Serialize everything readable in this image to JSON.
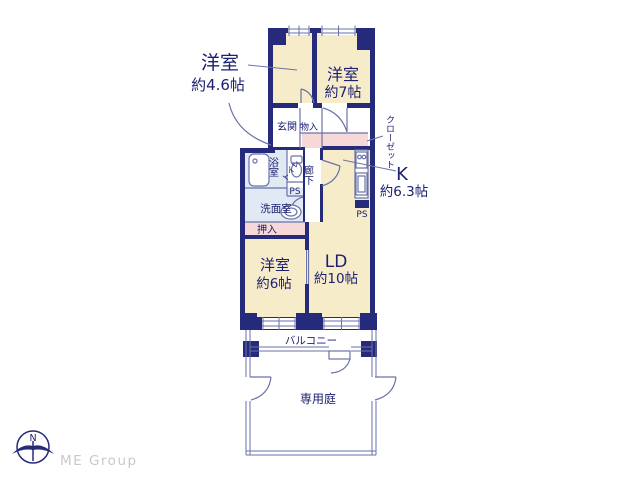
{
  "rooms": {
    "bedroom46": {
      "label": "洋室",
      "size": "約4.6帖"
    },
    "bedroom7": {
      "label": "洋室",
      "size": "約7帖"
    },
    "bedroom6": {
      "label": "洋室",
      "size": "約6帖"
    },
    "living": {
      "label": "LD",
      "size": "約10帖"
    },
    "kitchen": {
      "label": "K",
      "size": "約6.3帖"
    },
    "entrance": {
      "label": "玄関"
    },
    "storage": {
      "label": "物入"
    },
    "closet": {
      "label": "クローゼット"
    },
    "bath": {
      "label": "浴室"
    },
    "toilet": {
      "label": "トイレ"
    },
    "hallway": {
      "label": "廊下"
    },
    "washroom": {
      "label": "洗面室"
    },
    "futon_closet": {
      "label": "押入"
    },
    "pipe_space_1": {
      "label": "PS"
    },
    "pipe_space_2": {
      "label": "PS"
    },
    "balcony": {
      "label": "バルコニー"
    },
    "private_garden": {
      "label": "専用庭"
    }
  },
  "compass": {
    "north_label": "N"
  },
  "branding": {
    "logo_text": "ME Group"
  },
  "colors": {
    "wall": "#252a7a",
    "room_fill": "#f7ecca",
    "closet_fill": "#f6d8d8",
    "wet_area_fill": "#e1eaf4",
    "thin_line": "#6a72a8",
    "text": "#1c2070",
    "brand_text": "#c9c9c9"
  }
}
